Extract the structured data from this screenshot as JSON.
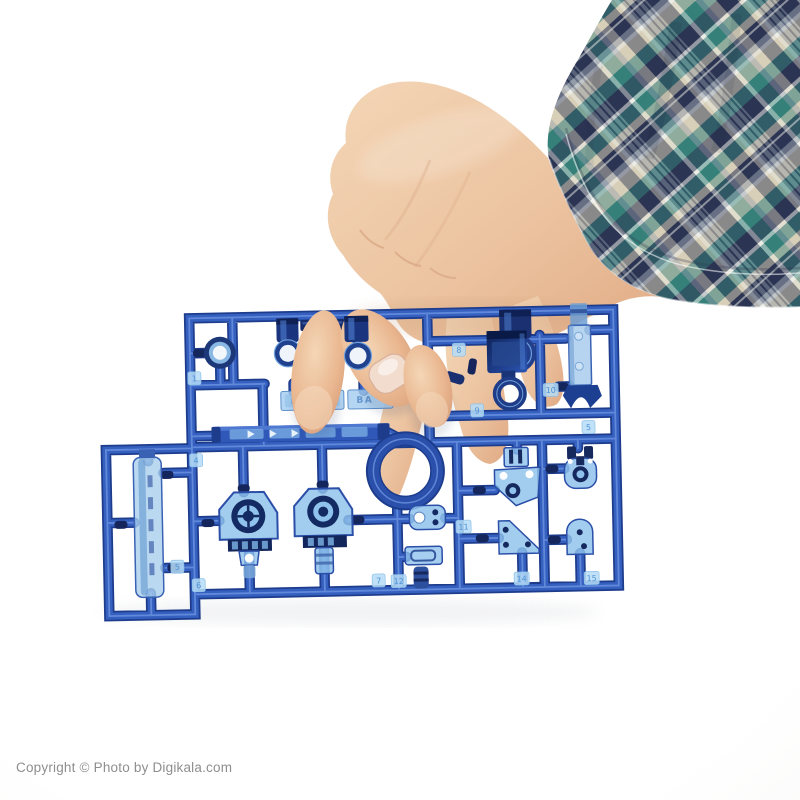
{
  "image": {
    "type": "product-photo",
    "subject": "Hand holding a transparent blue plastic model-kit parts sprue (runner)",
    "background_color": "#f6f5f3"
  },
  "watermark": {
    "text": "Copyright © Photo by Digikala.com",
    "color": "#8e8e8e"
  },
  "hand": {
    "skin_color": "#eac2a0",
    "nail_color": "#f2dccd"
  },
  "sleeve": {
    "pattern": "plaid",
    "colors": {
      "navy": "#2b3451",
      "teal": "#36807a",
      "tan": "#d6cfba",
      "white": "#ecede7",
      "gray": "#8f99a7"
    }
  },
  "sprue": {
    "plastic_color": "#2f58b8",
    "dark_plastic_color": "#15265c",
    "translucent_plastic_color": "#9cc8ee",
    "brand_plate": {
      "embossed_text": "KENKO",
      "secondary_text": "BA"
    },
    "rail_arrow_count": 3,
    "tags": [
      {
        "n": "1"
      },
      {
        "n": "4"
      },
      {
        "n": "5"
      },
      {
        "n": "6"
      },
      {
        "n": "8"
      },
      {
        "n": "9"
      },
      {
        "n": "10"
      },
      {
        "n": "5"
      },
      {
        "n": "11"
      },
      {
        "n": "7"
      },
      {
        "n": "12"
      },
      {
        "n": "14"
      },
      {
        "n": "15"
      }
    ],
    "parts": [
      "washer-ring",
      "small-cylinder-with-ring",
      "t-connector",
      "small-cylinder-with-ring-2",
      "large-cylinder-with-ring",
      "bucket-cup-with-ring",
      "rod-with-claw",
      "ribbed-rail",
      "large-ring",
      "hub-housing-left",
      "hub-housing-right",
      "long-tube",
      "eyelet-tab",
      "slot-box",
      "strut-bracket",
      "fork-bracket",
      "triangle-plate",
      "arch-plate"
    ]
  }
}
